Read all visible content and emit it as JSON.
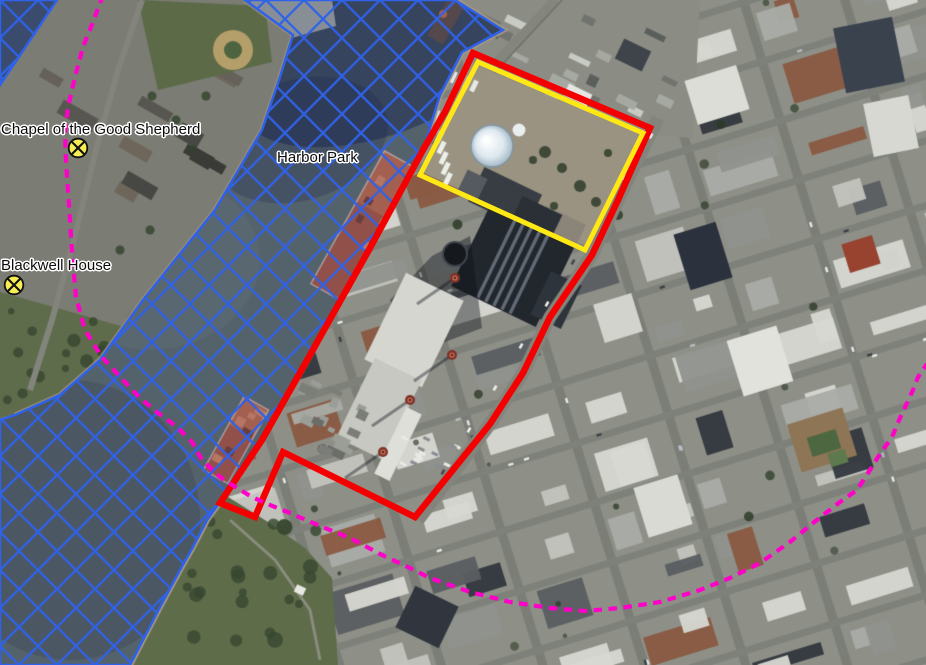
{
  "map": {
    "view": "satellite",
    "labels": [
      {
        "text": "Chapel of the Good Shepherd",
        "x": 1,
        "y": 121
      },
      {
        "text": "Harbor Park",
        "x": 277,
        "y": 149
      },
      {
        "text": "Blackwell House",
        "x": 1,
        "y": 257
      }
    ],
    "markers": [
      {
        "id": "chapel-of-the-good-shepherd-marker",
        "x": 78,
        "y": 148,
        "icon": "circle-x",
        "fill": "#f7ee52"
      },
      {
        "id": "blackwell-house-marker",
        "x": 14,
        "y": 285,
        "icon": "circle-x",
        "fill": "#f7ee52"
      }
    ],
    "overlays": {
      "water_hatch": {
        "stroke": "#2f62ea",
        "tint": "rgba(47,98,234,0.10)",
        "pattern": "diagonal-crosshatch",
        "line_spacing": 27,
        "regions": {
          "river": [
            [
              245,
              0
            ],
            [
              293,
              35
            ],
            [
              280,
              77
            ],
            [
              262,
              130
            ],
            [
              215,
              210
            ],
            [
              175,
              260
            ],
            [
              143,
              300
            ],
            [
              100,
              360
            ],
            [
              60,
              395
            ],
            [
              15,
              415
            ],
            [
              0,
              420
            ],
            [
              0,
              665
            ],
            [
              130,
              665
            ],
            [
              143,
              640
            ],
            [
              160,
              607
            ],
            [
              180,
              570
            ],
            [
              193,
              547
            ],
            [
              207,
              520
            ],
            [
              225,
              495
            ],
            [
              262,
              440
            ],
            [
              310,
              355
            ],
            [
              370,
              248
            ],
            [
              423,
              150
            ],
            [
              440,
              95
            ],
            [
              462,
              52
            ],
            [
              503,
              30
            ],
            [
              455,
              0
            ]
          ],
          "corner": [
            [
              0,
              0
            ],
            [
              57,
              0
            ],
            [
              0,
              85
            ]
          ]
        }
      },
      "red_boundary": {
        "stroke": "#f40000",
        "width": 6.5,
        "closed": true,
        "points": [
          [
            473,
            53
          ],
          [
            650,
            128
          ],
          [
            618,
            200
          ],
          [
            592,
            255
          ],
          [
            550,
            317
          ],
          [
            523,
            373
          ],
          [
            490,
            424
          ],
          [
            415,
            517
          ],
          [
            283,
            452
          ],
          [
            255,
            517
          ],
          [
            220,
            503
          ],
          [
            262,
            440
          ],
          [
            310,
            355
          ],
          [
            370,
            248
          ],
          [
            423,
            150
          ],
          [
            445,
            112
          ]
        ]
      },
      "yellow_boundary": {
        "stroke": "#ffe814",
        "width": 5,
        "closed": true,
        "points": [
          [
            478,
            62
          ],
          [
            643,
            133
          ],
          [
            585,
            250
          ],
          [
            420,
            175
          ]
        ]
      },
      "magenta_line": {
        "stroke": "#ff00c8",
        "width": 4.2,
        "dash": "8.5 6.5",
        "points": [
          [
            103,
            -5
          ],
          [
            93,
            22
          ],
          [
            83,
            47
          ],
          [
            75,
            77
          ],
          [
            68,
            107
          ],
          [
            65,
            132
          ],
          [
            66,
            162
          ],
          [
            69,
            205
          ],
          [
            72,
            252
          ],
          [
            76,
            297
          ],
          [
            85,
            330
          ],
          [
            101,
            356
          ],
          [
            123,
            380
          ],
          [
            140,
            398
          ],
          [
            158,
            413
          ],
          [
            177,
            427
          ],
          [
            192,
            442
          ],
          [
            202,
            460
          ],
          [
            220,
            477
          ],
          [
            237,
            488
          ],
          [
            252,
            497
          ],
          [
            270,
            505
          ],
          [
            290,
            513
          ],
          [
            320,
            526
          ],
          [
            350,
            538
          ],
          [
            382,
            555
          ],
          [
            410,
            568
          ],
          [
            430,
            578
          ],
          [
            470,
            592
          ],
          [
            510,
            602
          ],
          [
            550,
            608
          ],
          [
            585,
            611
          ],
          [
            620,
            608
          ],
          [
            660,
            602
          ],
          [
            700,
            590
          ],
          [
            730,
            578
          ],
          [
            760,
            563
          ],
          [
            790,
            542
          ],
          [
            813,
            523
          ],
          [
            840,
            502
          ],
          [
            857,
            490
          ],
          [
            870,
            470
          ],
          [
            878,
            457
          ],
          [
            892,
            437
          ],
          [
            900,
            418
          ],
          [
            907,
            403
          ],
          [
            913,
            390
          ],
          [
            918,
            377
          ],
          [
            927,
            364
          ]
        ]
      }
    }
  }
}
